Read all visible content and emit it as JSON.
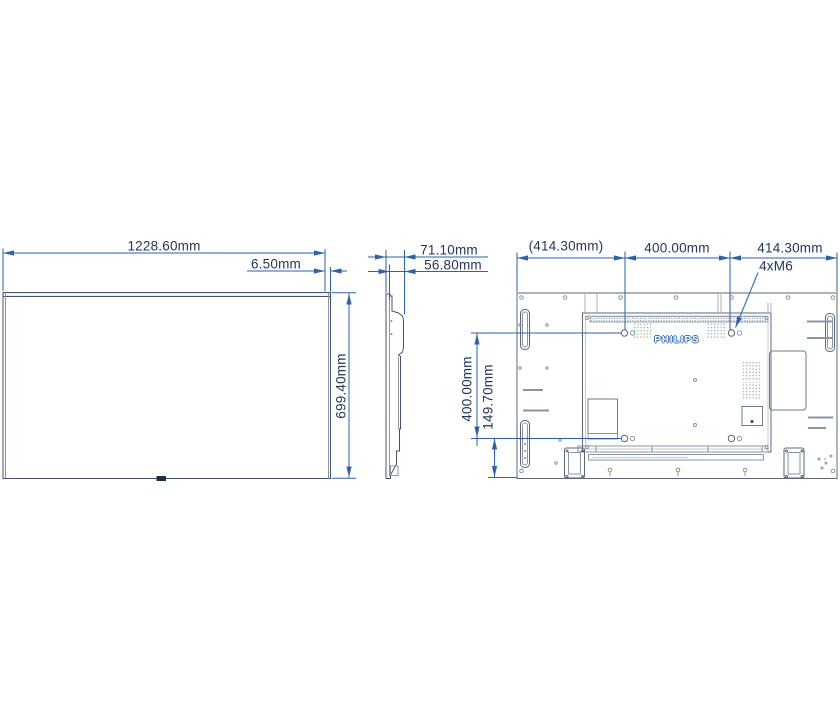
{
  "colors": {
    "dimension_blue": "#2d62a8",
    "text_navy": "#22365c",
    "drawing_dark": "#44536a",
    "drawing_mid": "#5a6878",
    "drawing_light": "#8a95a3",
    "philips_blue": "#4273b3",
    "background": "#ffffff"
  },
  "front_view": {
    "width": "1228.60mm",
    "bezel": "6.50mm",
    "height": "699.40mm"
  },
  "side_view": {
    "depth_total": "71.10mm",
    "depth_body": "56.80mm"
  },
  "rear_view": {
    "left_span": "(414.30mm)",
    "vesa_width": "400.00mm",
    "right_span": "414.30mm",
    "mount_screws": "4xM6",
    "vesa_height": "400.00mm",
    "bottom_offset": "149.70mm",
    "brand_logo": "PHILIPS"
  }
}
